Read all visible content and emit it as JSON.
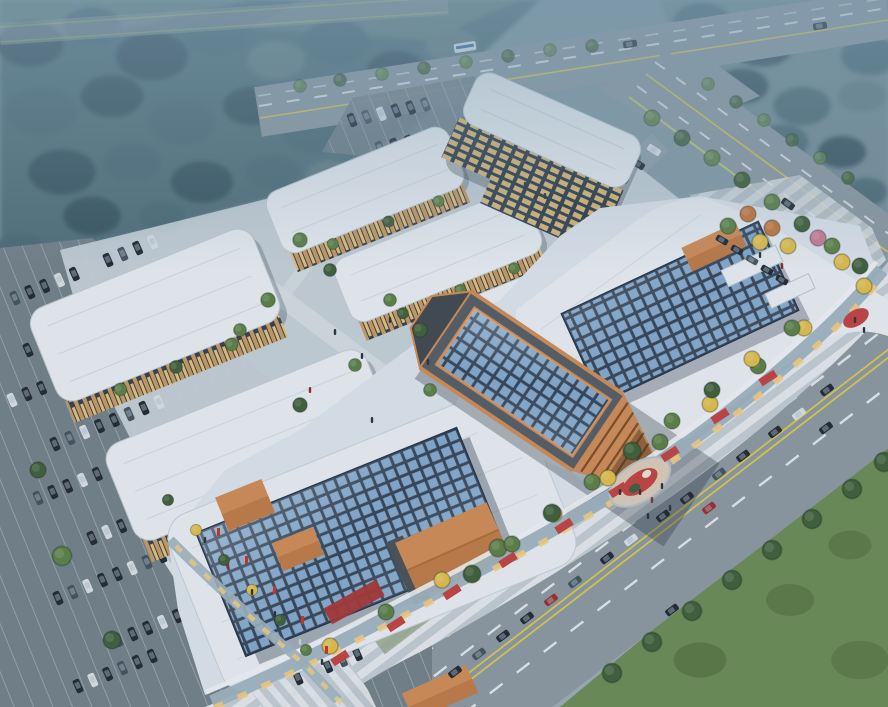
{
  "scene": {
    "type": "aerial-architectural-rendering",
    "subject": "Dusk aerial rendering of a commercial retail complex: shopping mall with blue glass grid skylights and copper atrium, five white-roofed retail strip buildings, mid-rise office block at a road intersection, tree-lined perimeter roads, striped pedestrian plazas with autumn trees and red flower beds, and parking lots filled with cars",
    "elements": [
      "forest-northwest",
      "forest-northeast",
      "grass-southeast",
      "top-road",
      "northeast-road",
      "southeast-road",
      "road-intersection",
      "west-parking-lot",
      "north-parking-lot",
      "retail-strip x5",
      "office-building",
      "mall-south-wing",
      "mall-north-wing",
      "mall-atrium",
      "skylight-grids",
      "copper-canopies",
      "glass-facade",
      "red-accent-band",
      "front-plaza",
      "west-promenade",
      "entrance-plaza-garden",
      "street-trees",
      "flower-beds",
      "parked-cars",
      "driving-cars",
      "bus",
      "pedestrians",
      "banner-flags"
    ]
  },
  "palette": {
    "bg_top": "#7d95a0",
    "bg_bottom": "#9fabb5",
    "haze": "#86a4b8",
    "forest_base": "#4e6b76",
    "forest_dark": "#3c5662",
    "forest_light": "#647f86",
    "meadow": "#7f9c90",
    "grass": "#6d8c58",
    "grass_dark": "#54703f",
    "road": "#8d98a2",
    "road_line_white": "#e9eef3",
    "road_line_yellow": "#d9c84e",
    "road_edge_green": "#c6d86a",
    "asphalt": "#74818b",
    "stall_line": "#cdd6dc",
    "drive": "#97a3ad",
    "parklane": "#9aa78f",
    "roof_white": "#e7ebf1",
    "roof_mall": "#dce3eb",
    "roof_shade": "#b9c5d1",
    "skylight_frame": "#2c3b4e",
    "skylight_glass": "#7da3c9",
    "atrium_gray": "#575e66",
    "atrium_gray_dark": "#434a52",
    "copper": "#d08c57",
    "copper_dark": "#b06f3c",
    "lattice_shadow": "#7c4f2b",
    "wood_facade": "#c49a66",
    "window_warm": "#f6cd7e",
    "window_dark": "#3a4150",
    "glass_facade": "#9fb2bf",
    "red_accent": "#a83838",
    "flower_red": "#c14444",
    "tree_green": "#5e8148",
    "tree_green_dark": "#42603a",
    "tree_yellow": "#e0bd4c",
    "tree_orange": "#c4763c",
    "tree_blossom": "#c77d95",
    "plaza_light": "#e2e6ea",
    "plaza_dark": "#c2cbd3",
    "plaza_warm": "#d9cbb9",
    "paving_spine": "#d6dde3",
    "car_dark": "#232b35",
    "car_mid": "#46545f",
    "car_white": "#d9dfe4",
    "car_red": "#9c2f2f",
    "people": "#2e343d"
  }
}
